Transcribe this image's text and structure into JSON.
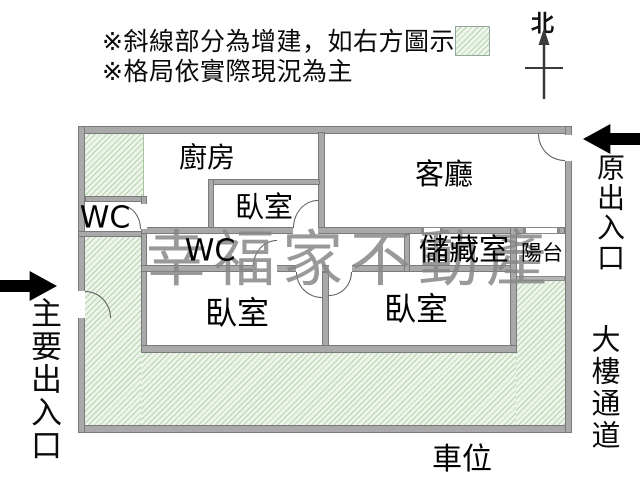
{
  "notes": {
    "line1": "※斜線部分為增建，如右方圖示",
    "line2": "※格局依實際現況為主"
  },
  "compass": {
    "north": "北"
  },
  "legend": {
    "swatch_icon": "hatch-addition-swatch"
  },
  "rooms": {
    "kitchen": "廚房",
    "bedroom_top": "臥室",
    "living_room": "客廳",
    "wc_upper": "WC",
    "wc_lower": "WC",
    "storage": "儲藏室",
    "balcony": "陽台",
    "bedroom_left": "臥室",
    "bedroom_right": "臥室"
  },
  "annotations": {
    "parking": "車位",
    "main_entrance": "主要出入口",
    "original_entrance": "原出入口",
    "building_passage": "大樓通道"
  },
  "watermark": {
    "text": "幸福家不動產"
  },
  "colors": {
    "wall": "#a9a9a9",
    "wall_edge": "#7a7a7a",
    "hatch_background": "#edf4ea",
    "hatch_line": "#b7d3b0",
    "watermark": "#878787",
    "arrow": "#000000",
    "text": "#0a0a0a"
  }
}
